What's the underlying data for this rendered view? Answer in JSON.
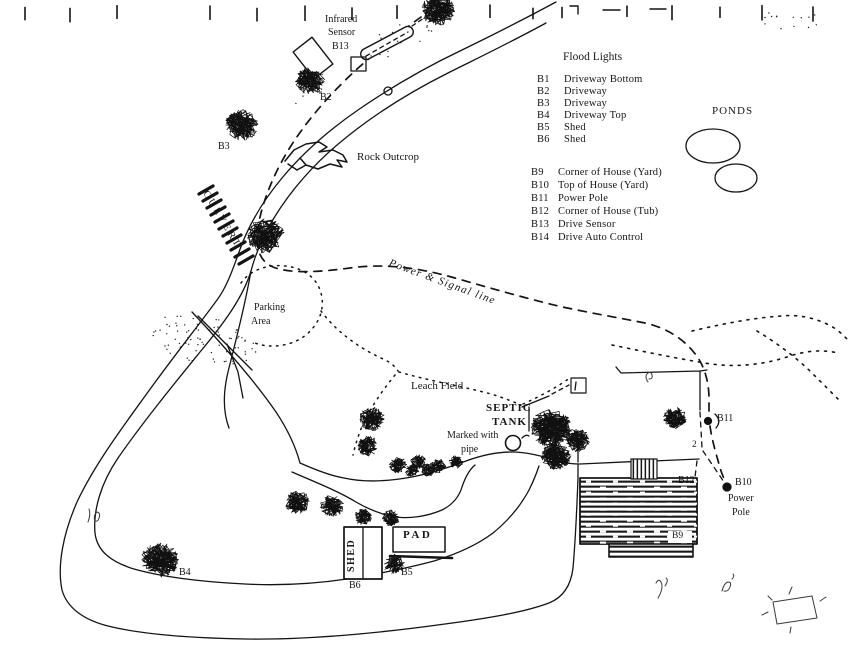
{
  "legend": {
    "title": "Flood Lights",
    "items": [
      {
        "id": "B1",
        "label": "Driveway Bottom"
      },
      {
        "id": "B2",
        "label": "Driveway"
      },
      {
        "id": "B3",
        "label": "Driveway"
      },
      {
        "id": "B4",
        "label": "Driveway Top"
      },
      {
        "id": "B5",
        "label": "Shed"
      },
      {
        "id": "B6",
        "label": "Shed"
      },
      {
        "id": "B9",
        "label": "Corner of House (Yard)"
      },
      {
        "id": "B10",
        "label": "Top of House (Yard)"
      },
      {
        "id": "B11",
        "label": "Power Pole"
      },
      {
        "id": "B12",
        "label": "Corner of House (Tub)"
      },
      {
        "id": "B13",
        "label": "Drive Sensor"
      },
      {
        "id": "B14",
        "label": "Drive Auto Control"
      }
    ]
  },
  "map_labels": {
    "ponds": "PONDS",
    "rock_outcrop": "Rock Outcrop",
    "culvert": "CULVERT",
    "power_signal_line": "Power & Signal line",
    "parking_area_line1": "Parking",
    "parking_area_line2": "Area",
    "leach_field": "Leach Field",
    "septic_tank_line1": "SEPTIC",
    "septic_tank_line2": "TANK",
    "marked_with_pipe_line1": "Marked with",
    "marked_with_pipe_line2": "pipe",
    "infrared_sensor_line1": "Infrared",
    "infrared_sensor_line2": "Sensor",
    "infrared_sensor_line3": "B13",
    "shed": "SHED",
    "pad": "PAD"
  },
  "point_labels": {
    "b2": "B2",
    "b3": "B3",
    "b4": "B4",
    "b5": "B5",
    "b6": "B6",
    "b9": "B9",
    "b11": "B11",
    "b12": "B12",
    "b10_line1": "B10",
    "b10_line2": "Power",
    "b10_line3": "Pole"
  },
  "annotations": {
    "yard_mark": "2"
  }
}
